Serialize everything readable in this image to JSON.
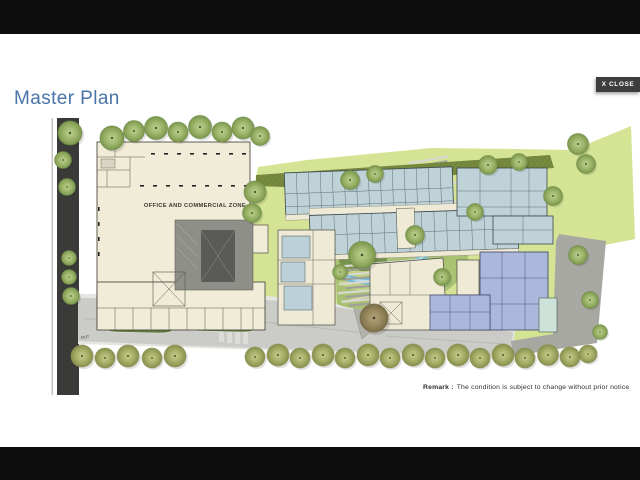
{
  "titlebar": {
    "title": "Master Plan",
    "title_color": "#4a73a8"
  },
  "close_button": {
    "label": "X CLOSE",
    "background": "#3d3d3d",
    "text_color": "#ffffff"
  },
  "plan": {
    "office_zone_label": "OFFICE AND COMMERCIAL ZONE",
    "exit_label": "OUT"
  },
  "remark": {
    "label": "Remark :",
    "text": "The condition is subject to change without prior notice"
  },
  "palette": {
    "letterbox": "#0d0d0d",
    "cream_building": "#f1ecd7",
    "residential_blue": "#bed2d8",
    "periwinkle_building": "#abb8dc",
    "aqua_building": "#cde2d9",
    "lawn_green": "#d5e494",
    "hedge_green": "#76893f",
    "garden_green": "#a9c173",
    "water_blue": "#6fb9d7",
    "road_light": "#cbcbc7",
    "road_dark": "#3a3a38",
    "tree_olive": "#9cb56a"
  }
}
